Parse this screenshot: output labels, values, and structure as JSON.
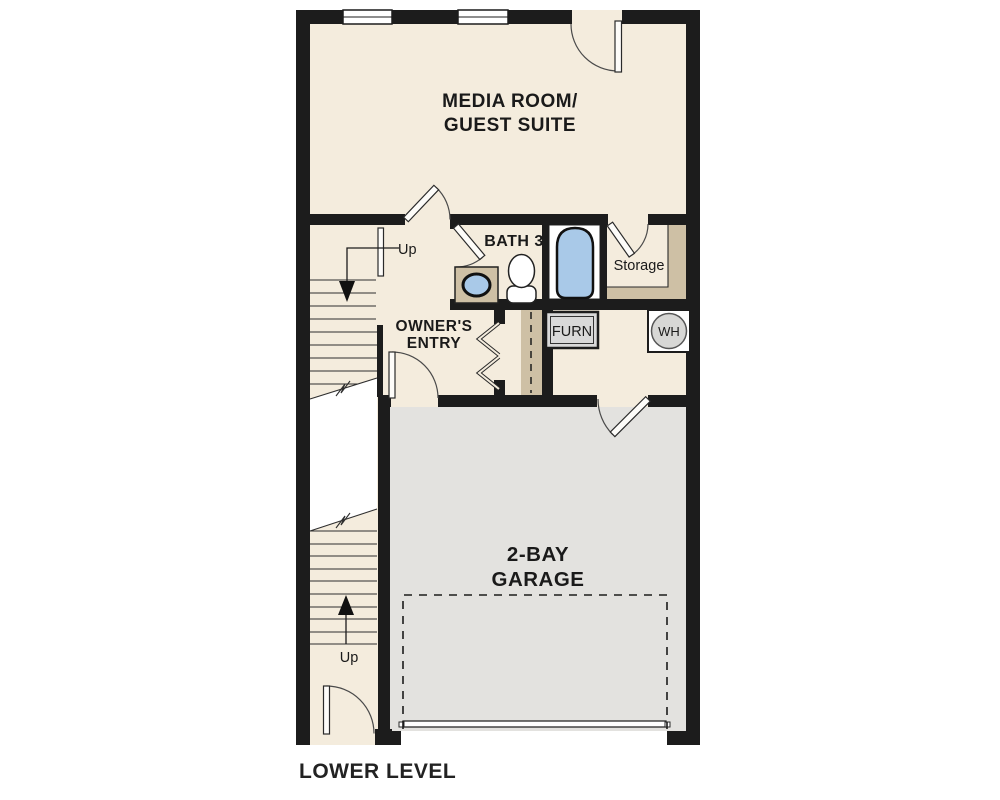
{
  "plan": {
    "title": "LOWER LEVEL",
    "rooms": {
      "media_room": {
        "line1": "MEDIA ROOM/",
        "line2": "GUEST SUITE"
      },
      "bath": {
        "label": "BATH 3"
      },
      "storage": {
        "label": "Storage"
      },
      "owners_entry": {
        "line1": "OWNER'S",
        "line2": "ENTRY"
      },
      "garage": {
        "line1": "2-BAY",
        "line2": "GARAGE"
      }
    },
    "equipment": {
      "furnace": "FURN",
      "water_heater": "WH"
    },
    "stairs": {
      "upper_label": "Up",
      "lower_label": "Up"
    },
    "colors": {
      "wall": "#1c1c1c",
      "room_fill": "#f4ecdd",
      "garage_fill": "#e3e2df",
      "accent_tan": "#cec0a5",
      "fixture_blue": "#a9c9e8",
      "equipment_gray": "#d9d9d9",
      "text": "#1a1a1a"
    }
  }
}
